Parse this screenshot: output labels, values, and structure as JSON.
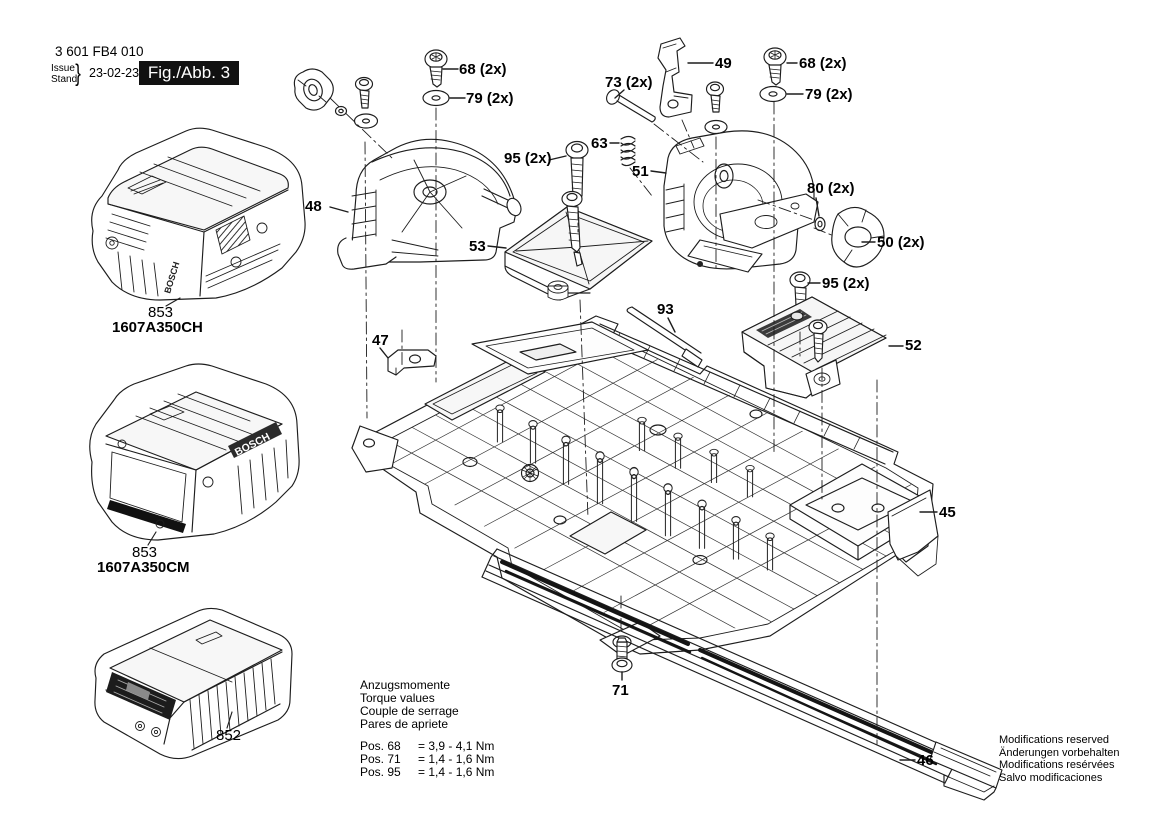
{
  "header": {
    "part_number": "3 601 FB4 010",
    "issue_label": "Issue",
    "stand_label": "Stand",
    "brace": "}",
    "date": "23-02-23",
    "figure_label": "Fig./Abb. 3"
  },
  "brand": "BOSCH",
  "products": [
    {
      "ref": "853",
      "model": "1607A350CH"
    },
    {
      "ref": "853",
      "model": "1607A350CM"
    },
    {
      "ref": "852",
      "model": ""
    }
  ],
  "callouts": [
    {
      "id": "68-left",
      "text": "68 (2x)"
    },
    {
      "id": "79-left",
      "text": "79 (2x)"
    },
    {
      "id": "73",
      "text": "73 (2x)"
    },
    {
      "id": "49",
      "text": "49"
    },
    {
      "id": "68-right",
      "text": "68 (2x)"
    },
    {
      "id": "79-right",
      "text": "79 (2x)"
    },
    {
      "id": "63",
      "text": "63"
    },
    {
      "id": "95-left",
      "text": "95 (2x)"
    },
    {
      "id": "51",
      "text": "51"
    },
    {
      "id": "80",
      "text": "80 (2x)"
    },
    {
      "id": "50",
      "text": "50 (2x)"
    },
    {
      "id": "95-right",
      "text": "95 (2x)"
    },
    {
      "id": "53",
      "text": "53"
    },
    {
      "id": "93",
      "text": "93"
    },
    {
      "id": "47",
      "text": "47"
    },
    {
      "id": "52",
      "text": "52"
    },
    {
      "id": "48",
      "text": "48"
    },
    {
      "id": "45",
      "text": "45"
    },
    {
      "id": "71",
      "text": "71"
    },
    {
      "id": "46",
      "text": "46"
    }
  ],
  "torque": {
    "titles": [
      "Anzugsmomente",
      "Torque values",
      "Couple de serrage",
      "Pares de apriete"
    ],
    "rows": [
      {
        "pos": "Pos. 68",
        "value": "= 3,9 - 4,1 Nm"
      },
      {
        "pos": "Pos. 71",
        "value": "= 1,4 - 1,6 Nm"
      },
      {
        "pos": "Pos. 95",
        "value": "= 1,4 - 1,6 Nm"
      }
    ]
  },
  "footer_notes": [
    "Modifications reserved",
    "Änderungen vorbehalten",
    "Modifications resérvées",
    "Salvo modificaciones"
  ],
  "colors": {
    "line": "#1d1d1d",
    "dark": "#141414",
    "fill_light": "#f4f4f4",
    "fill_mid": "#e2e2e2"
  }
}
